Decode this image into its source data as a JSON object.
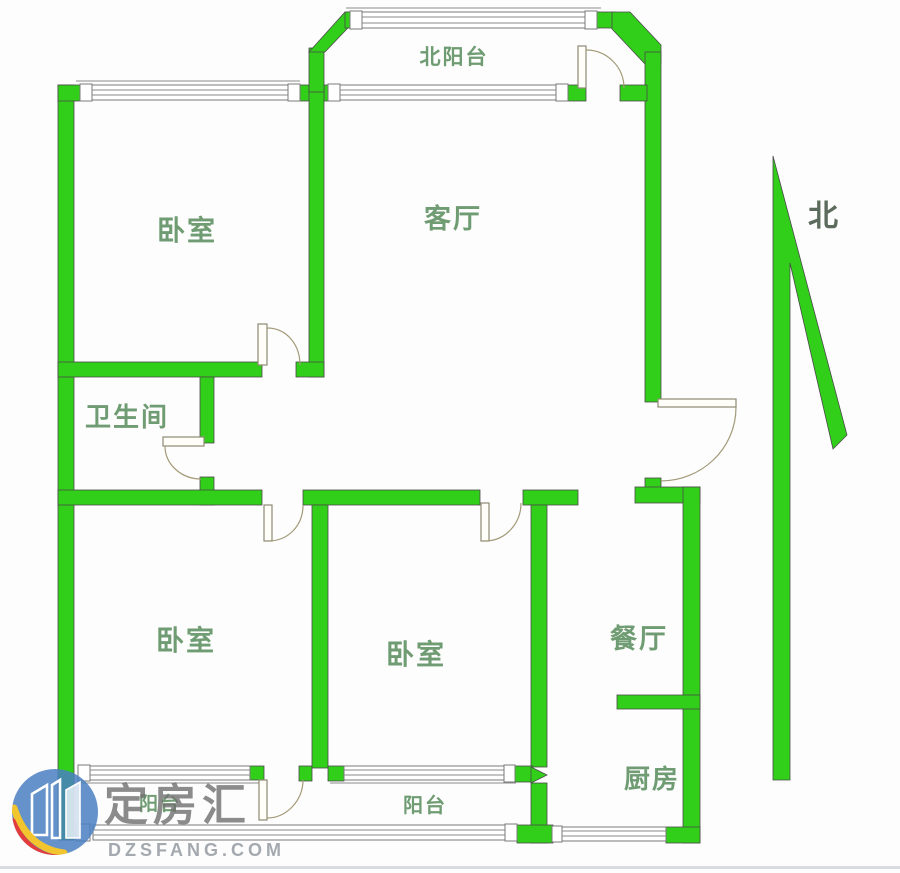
{
  "floorplan": {
    "rooms": [
      {
        "name": "north-balcony",
        "label": "北阳台"
      },
      {
        "name": "bedroom-top-left",
        "label": "卧室"
      },
      {
        "name": "living-room",
        "label": "客厅"
      },
      {
        "name": "bathroom",
        "label": "卫生间"
      },
      {
        "name": "bedroom-lower-left",
        "label": "卧室"
      },
      {
        "name": "bedroom-lower-middle",
        "label": "卧室"
      },
      {
        "name": "dining-room",
        "label": "餐厅"
      },
      {
        "name": "kitchen",
        "label": "厨房"
      },
      {
        "name": "balcony-left",
        "label": "阳台"
      },
      {
        "name": "balcony-middle",
        "label": "阳台"
      }
    ],
    "compass": {
      "label": "北"
    },
    "colors": {
      "wall": "#32CF1A",
      "room_label": "#6f9c72",
      "compass_label": "#5d6b5d"
    }
  },
  "watermark": {
    "brand": "定房汇",
    "domain": "DZSFANG.COM",
    "colors": {
      "logo_blue": "#4a7fc1",
      "logo_yellow": "#f2c52e",
      "logo_red": "#e23c3c",
      "brand_text": "#6f6f6f",
      "domain_text": "#9aa0a6"
    }
  }
}
